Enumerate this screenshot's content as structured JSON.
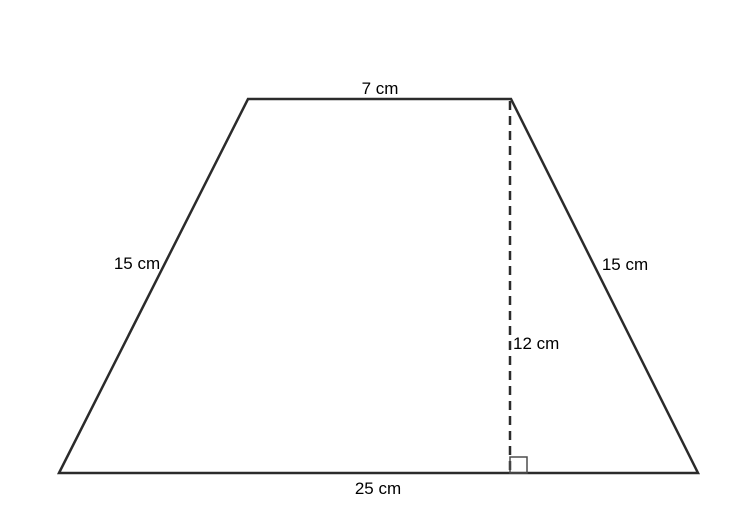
{
  "figure": {
    "type": "trapezoid-with-dimensions",
    "background": "#ffffff",
    "line_color": "#2b2b2b",
    "dash_color": "#2b2b2b",
    "marker_color": "#4d4d4d",
    "labels": {
      "top_base": "7 cm",
      "bottom_base": "25 cm",
      "left_side": "15 cm",
      "right_side": "15 cm",
      "height": "12 cm"
    }
  }
}
